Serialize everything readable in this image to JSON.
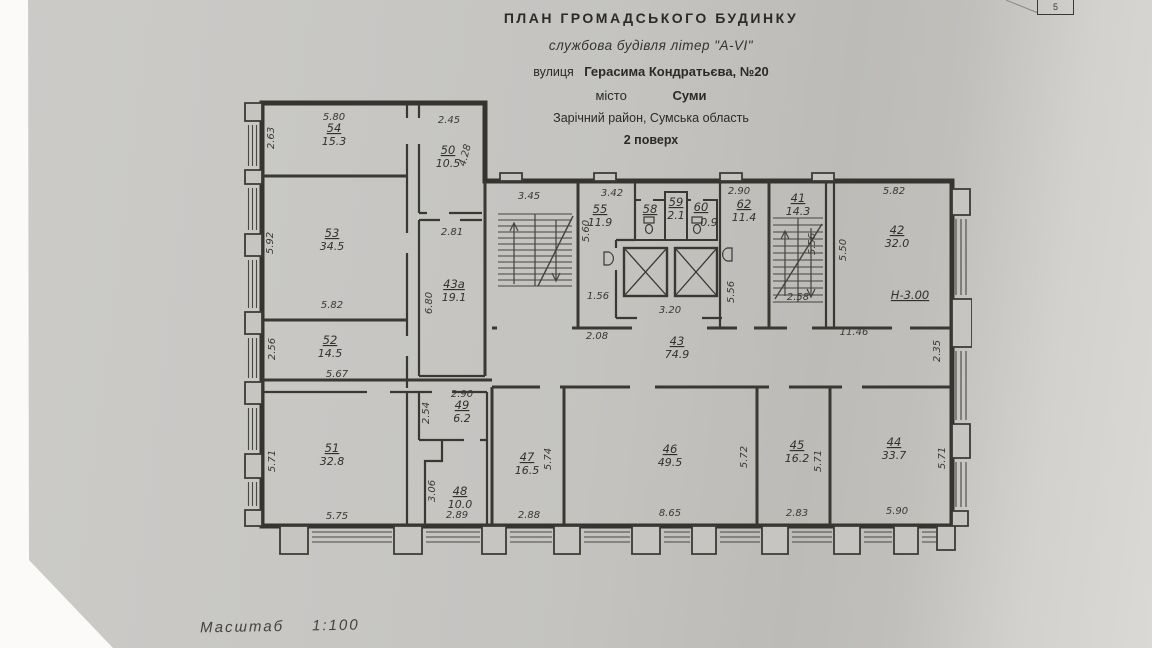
{
  "page": {
    "number": "5"
  },
  "title_block": {
    "line1": "ПЛАН  ГРОМАДСЬКОГО  БУДИНКУ",
    "line2": "службова будівля літер \"А-VI\"",
    "line3_prefix": "вулиця",
    "line3_value": "Герасима Кондратьєва, №20",
    "line4_prefix": "місто",
    "line4_value": "Суми",
    "line5": "Зарічний район, Сумська область",
    "line6": "2 поверх"
  },
  "scale": {
    "label": "Масштаб",
    "value": "1:100"
  },
  "rooms": {
    "r54": {
      "number": "54",
      "area": "15.3"
    },
    "r50": {
      "number": "50",
      "area": "10.5"
    },
    "r53": {
      "number": "53",
      "area": "34.5"
    },
    "r43a": {
      "number": "43a",
      "area": "19.1"
    },
    "r52": {
      "number": "52",
      "area": "14.5"
    },
    "r51": {
      "number": "51",
      "area": "32.8"
    },
    "r49": {
      "number": "49",
      "area": "6.2"
    },
    "r48": {
      "number": "48",
      "area": "10.0"
    },
    "r55": {
      "number": "55",
      "area": "11.9"
    },
    "r58": {
      "number": "58"
    },
    "r59": {
      "number": "59",
      "area": "2.1"
    },
    "r60": {
      "number": "60",
      "area": "0.9"
    },
    "r62": {
      "number": "62",
      "area": "11.4"
    },
    "r41": {
      "number": "41",
      "area": "14.3"
    },
    "r42": {
      "number": "42",
      "area": "32.0",
      "height_note": "Н-3.00"
    },
    "r43": {
      "number": "43",
      "area": "74.9"
    },
    "r47": {
      "number": "47",
      "area": "16.5"
    },
    "r46": {
      "number": "46",
      "area": "49.5"
    },
    "r45": {
      "number": "45",
      "area": "16.2"
    },
    "r44": {
      "number": "44",
      "area": "33.7"
    }
  },
  "dims": {
    "top_54": "5.80",
    "left_54": "2.63",
    "top_50": "2.45",
    "right_50": "4.28",
    "left_53": "5.92",
    "bottom_53": "5.82",
    "top_43a": "2.81",
    "left_43a": "6.80",
    "left_52": "2.56",
    "bottom_52": "5.67",
    "left_51": "5.71",
    "bottom_51": "5.75",
    "top_49": "2.90",
    "left_49": "2.54",
    "left_48": "3.06",
    "bottom_48": "2.89",
    "top_stair_left": "3.45",
    "top_55": "3.42",
    "left_55": "5.60",
    "bottom_55": "1.56",
    "top_62": "2.90",
    "right_62": "5.56",
    "elevator_bay": "3.20",
    "right_41": "5.56",
    "bottom_41": "2.58",
    "top_42": "5.82",
    "left_42": "5.50",
    "corridor_left": "2.08",
    "corridor_right": "11.46",
    "right_edge": "2.35",
    "bottom_47": "2.88",
    "right_47": "5.74",
    "bottom_46": "8.65",
    "right_46": "5.72",
    "bottom_45": "2.83",
    "right_45": "5.71",
    "bottom_44": "5.90",
    "right_44": "5.71"
  }
}
